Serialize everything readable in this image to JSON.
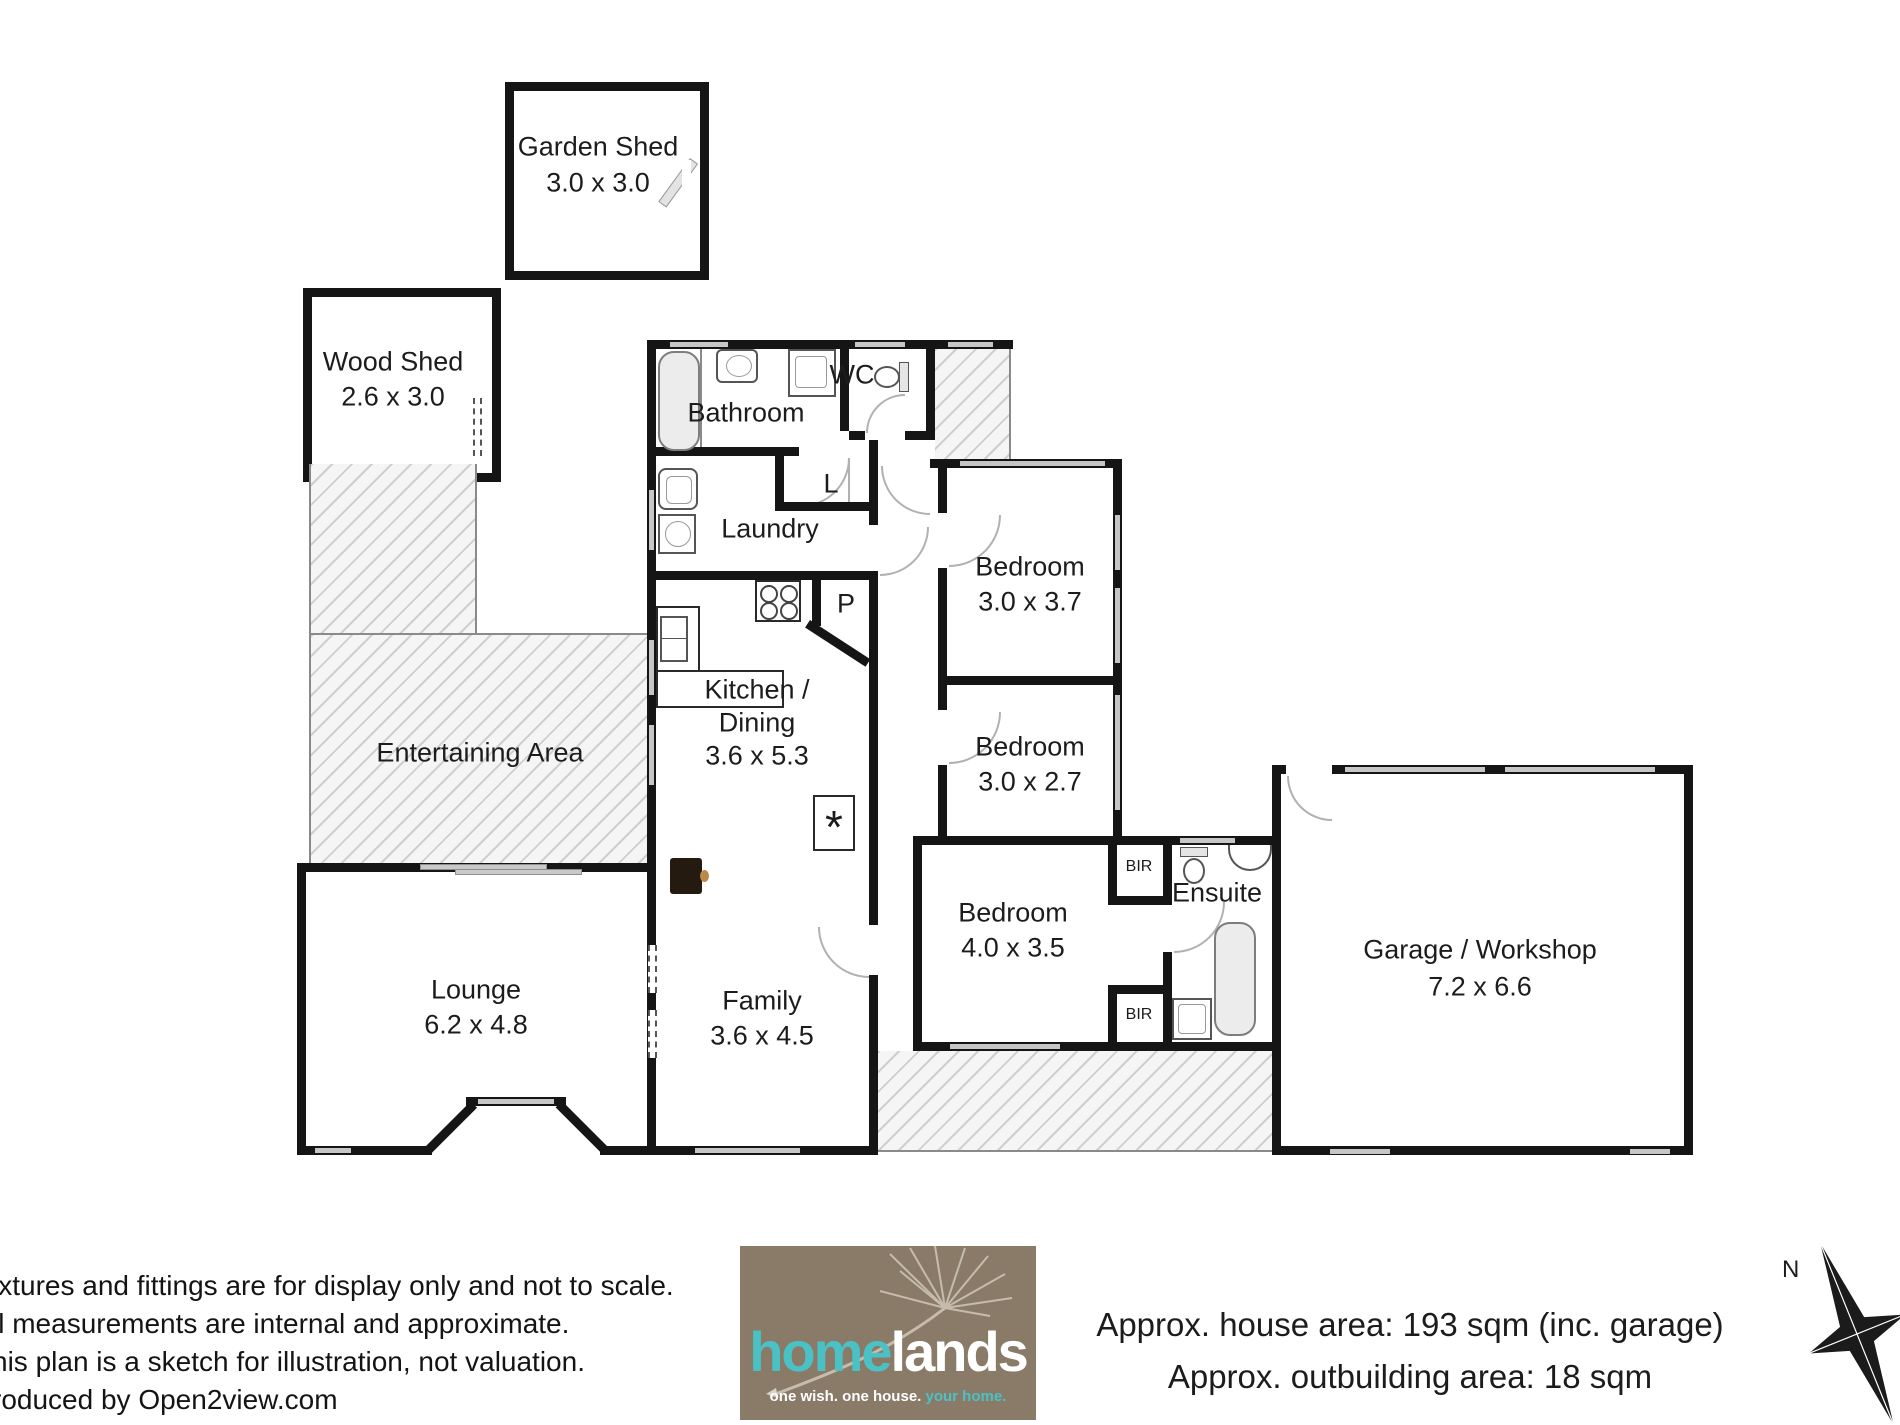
{
  "rooms": {
    "garden_shed": {
      "name": "Garden Shed",
      "dims": "3.0 x 3.0"
    },
    "wood_shed": {
      "name": "Wood Shed",
      "dims": "2.6 x 3.0"
    },
    "bathroom": {
      "name": "Bathroom"
    },
    "wc": {
      "name": "WC"
    },
    "laundry": {
      "name": "Laundry"
    },
    "linen": {
      "name": "L"
    },
    "pantry": {
      "name": "P"
    },
    "kitchen_dining": {
      "name_line1": "Kitchen /",
      "name_line2": "Dining",
      "dims": "3.6 x 5.3"
    },
    "entertaining": {
      "name": "Entertaining Area"
    },
    "lounge": {
      "name": "Lounge",
      "dims": "6.2 x 4.8"
    },
    "family": {
      "name": "Family",
      "dims": "3.6 x 4.5"
    },
    "bedroom1": {
      "name": "Bedroom",
      "dims": "3.0 x 3.7"
    },
    "bedroom2": {
      "name": "Bedroom",
      "dims": "3.0 x 2.7"
    },
    "bedroom3": {
      "name": "Bedroom",
      "dims": "4.0 x 3.5"
    },
    "bir_top": {
      "name": "BIR"
    },
    "bir_bottom": {
      "name": "BIR"
    },
    "ensuite": {
      "name": "Ensuite"
    },
    "garage": {
      "name": "Garage / Workshop",
      "dims": "7.2 x 6.6"
    },
    "heater_marker": "*"
  },
  "footer": {
    "disclaimer_lines": [
      "ixtures and fittings are for display only and not to scale.",
      "ll measurements are internal and approximate.",
      "his plan is a sketch for illustration, not valuation.",
      "roduced by Open2view.com"
    ],
    "areas_line1": "Approx. house area: 193 sqm (inc. garage)",
    "areas_line2": "Approx. outbuilding area: 18 sqm",
    "logo": {
      "brand_left": "home",
      "brand_right": "lands",
      "tagline_plain": "one wish. one house. ",
      "tagline_accent": "your home."
    },
    "compass_label": "N"
  },
  "colors": {
    "wall": "#151515",
    "window": "#c6c6c6",
    "hatch_line": "#cfcfcf",
    "logo_bg": "#8a7b68",
    "logo_teal": "#4ac2c5"
  }
}
